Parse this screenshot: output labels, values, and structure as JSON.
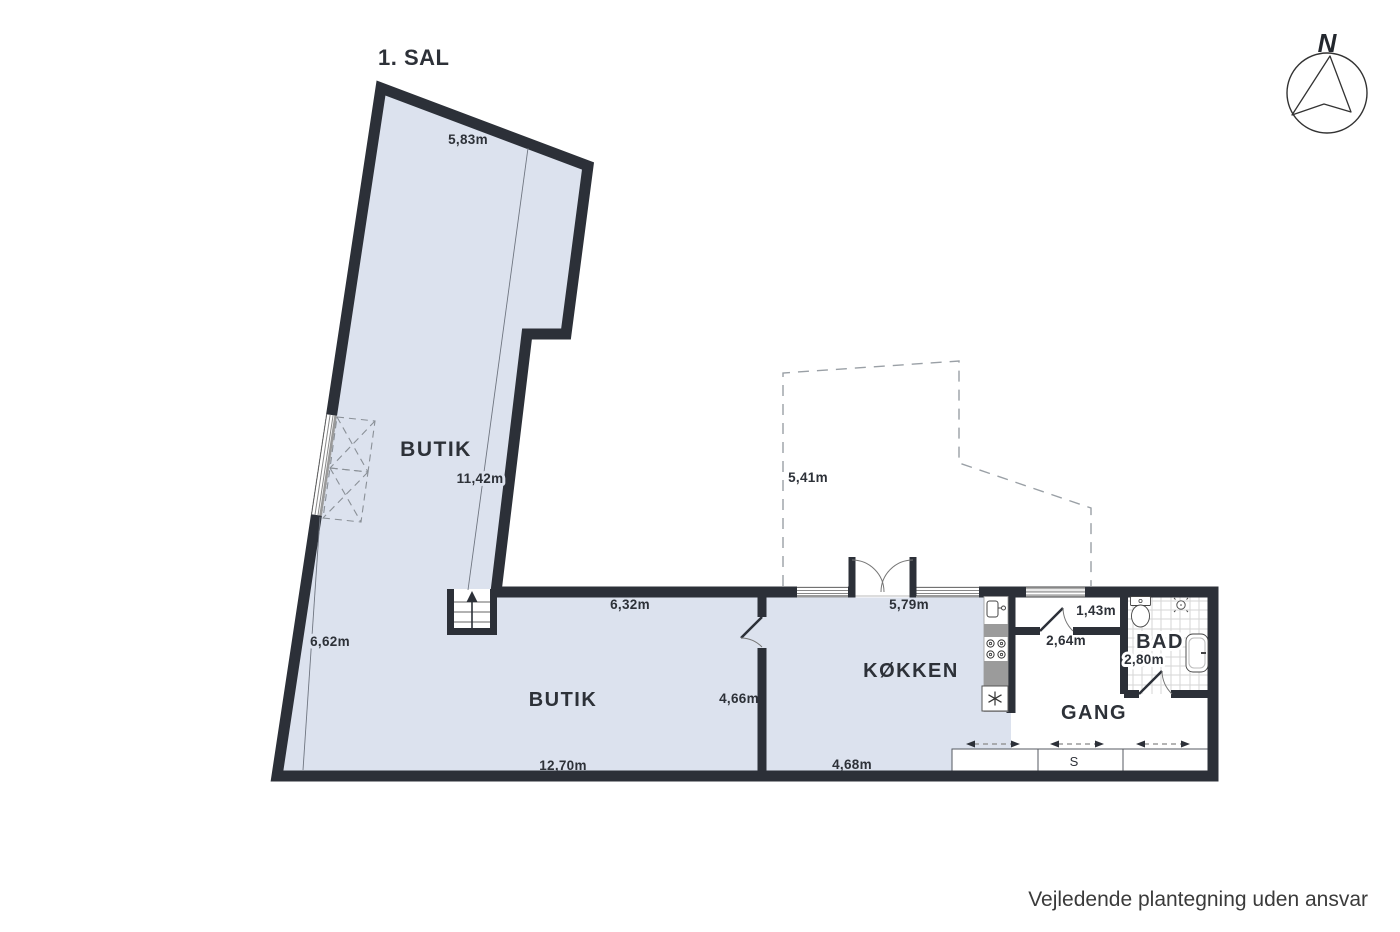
{
  "title": "1. SAL",
  "compass": {
    "north_label": "N"
  },
  "rooms": {
    "shop_upper": "BUTIK",
    "shop_lower": "BUTIK",
    "kitchen": "KØKKEN",
    "hallway": "GANG",
    "bathroom": "BAD",
    "closet": "S"
  },
  "dimensions": {
    "shop_upper_top": "5,83m",
    "shop_upper_length": "11,42m",
    "shop_upper_left": "6,62m",
    "shop_lower_top": "6,32m",
    "shop_lower_bottom": "12,70m",
    "shop_lower_right": "4,66m",
    "courtyard_left": "5,41m",
    "kitchen_top": "5,79m",
    "kitchen_bottom": "4,68m",
    "entry_width": "1,43m",
    "hallway_top": "2,64m",
    "bathroom_width": "2,80m"
  },
  "footer": {
    "disclaimer": "Vejledende plantegning uden ansvar"
  },
  "icons": [
    "compass-rose",
    "stairs-up-arrow",
    "kitchen-sink",
    "stove-burners",
    "refrigerator-snowflake",
    "toilet",
    "shower-head",
    "bathroom-sink",
    "french-doors",
    "sliding-wardrobe-arrows",
    "window",
    "dashed-annex-outline"
  ],
  "colors": {
    "wall": "#2c3038",
    "floor": "#dce2ee",
    "counter_gray": "#9b9b9b",
    "tile_line": "#d6d6d6",
    "dashed_line": "#9aa0a6",
    "dimension_line": "#6f7580",
    "text": "#2d3138",
    "background": "#ffffff"
  }
}
